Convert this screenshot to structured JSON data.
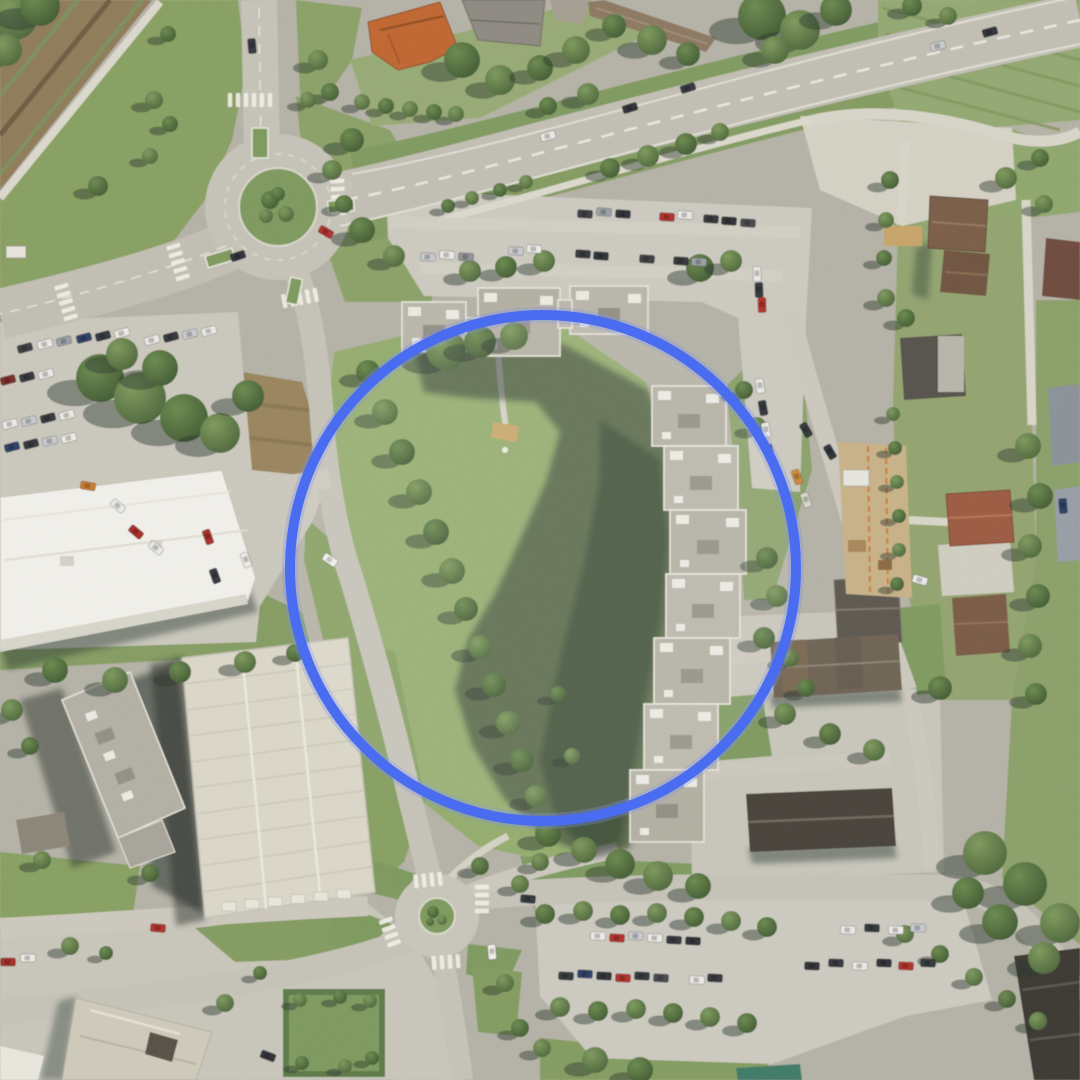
{
  "map": {
    "kind": "aerial-orthophoto",
    "annotation": {
      "shape": "circle",
      "cx": 543,
      "cy": 568,
      "r": 253,
      "stroke_color": "#4a6cf0",
      "stroke_width": 10,
      "fill": "rgba(255,255,255,0.08)"
    },
    "palette": {
      "road": "#c6c3b8",
      "path": "#d9d6c9",
      "grass": "#8ba167",
      "lawn_bright": "#95ad6e",
      "tree_dark": "#4a6338",
      "tree_light": "#7d9a5c",
      "shadow": "rgba(38,52,45,0.52)",
      "roof_light": "#b7b3a7",
      "roof_white": "#f2f1eb",
      "roof_orange": "#c0662f",
      "roof_brown": "#7b5d47",
      "dirt": "#8f7b57",
      "construction_orange": "#d07a30",
      "car_red": "#b23028",
      "car_white": "#ebeae6",
      "car_dark": "#2e3136"
    },
    "features": [
      "large-roundabout",
      "small-roundabout",
      "highway",
      "apartment-complex",
      "courtyard-lawn",
      "tree-lined-street",
      "parking-lots",
      "supermarket-building",
      "residential-houses",
      "garage-rows",
      "construction-site",
      "dirt-track"
    ]
  }
}
